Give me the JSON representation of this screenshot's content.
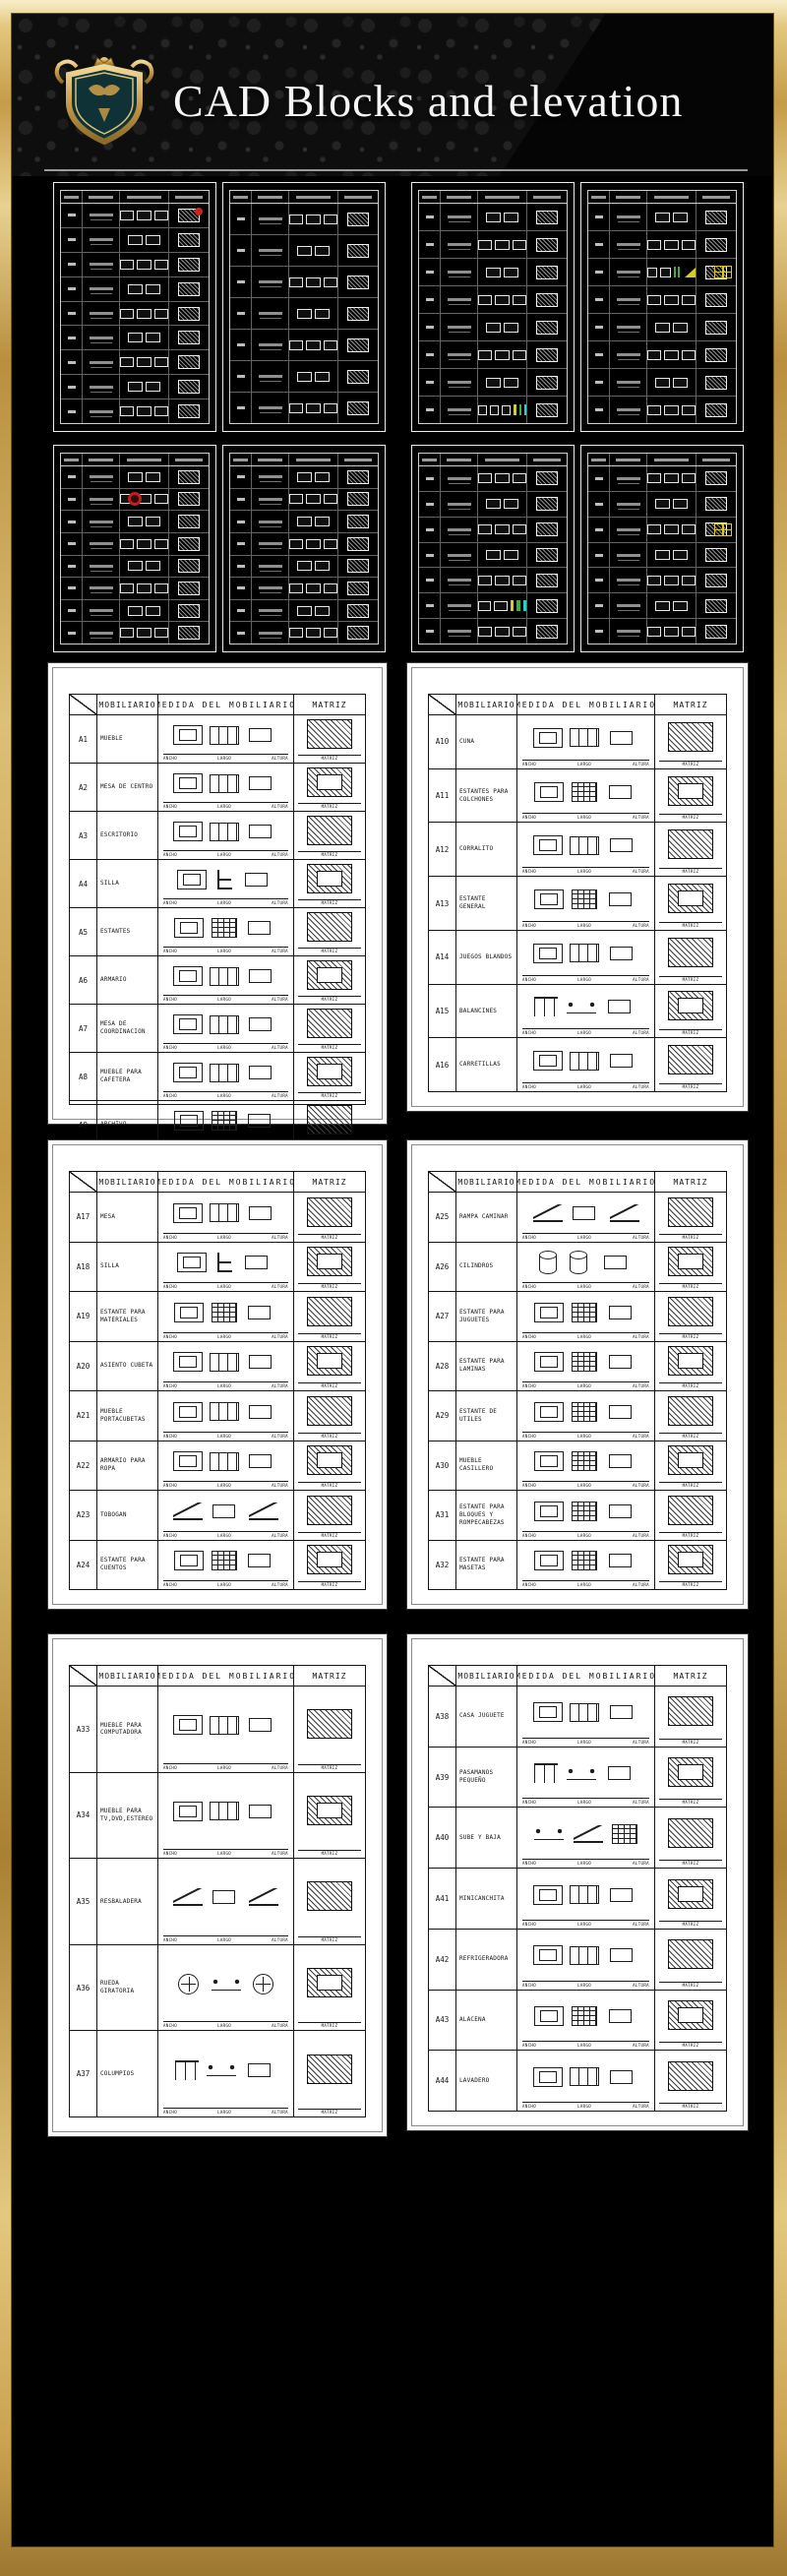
{
  "header": {
    "title": "CAD Blocks and elevation",
    "logo": "royal-crest-shield"
  },
  "colors": {
    "frame_gold": "#d9bc6d",
    "frame_gold_dark": "#a8813c",
    "background_black": "#000000",
    "sheet_white": "#ffffff",
    "line_black": "#141414",
    "dark_sheet_line": "#e6e6e6",
    "accent_red": "#cf2121",
    "accent_green": "#3fae3f",
    "accent_yellow": "#d8c832",
    "accent_cyan": "#3cc8c8",
    "title_white": "#f5f5f5"
  },
  "table_headers": {
    "furniture": "MOBILIARIO",
    "measure": "MEDIDA DEL MOBILIARIO",
    "matrix": "MATRIZ"
  },
  "dim_labels": {
    "width": "ANCHO",
    "length": "LARGO",
    "height": "ALTURA",
    "matrix": "MATRIZ"
  },
  "sheets": [
    {
      "key": "s1",
      "rows": [
        {
          "id": "A1",
          "name": "MUEBLE"
        },
        {
          "id": "A2",
          "name": "MESA DE CENTRO"
        },
        {
          "id": "A3",
          "name": "ESCRITORIO"
        },
        {
          "id": "A4",
          "name": "SILLA"
        },
        {
          "id": "A5",
          "name": "ESTANTES"
        },
        {
          "id": "A6",
          "name": "ARMARIO"
        },
        {
          "id": "A7",
          "name": "MESA DE COORDINACION"
        },
        {
          "id": "A8",
          "name": "MUEBLE PARA CAFETERA"
        },
        {
          "id": "A9",
          "name": "ARCHIVO"
        }
      ]
    },
    {
      "key": "s2",
      "rows": [
        {
          "id": "A10",
          "name": "CUNA"
        },
        {
          "id": "A11",
          "name": "ESTANTES PARA COLCHONES"
        },
        {
          "id": "A12",
          "name": "CORRALITO"
        },
        {
          "id": "A13",
          "name": "ESTANTE GENERAL"
        },
        {
          "id": "A14",
          "name": "JUEGOS BLANDOS"
        },
        {
          "id": "A15",
          "name": "BALANCINES"
        },
        {
          "id": "A16",
          "name": "CARRETILLAS"
        }
      ]
    },
    {
      "key": "s3",
      "rows": [
        {
          "id": "A17",
          "name": "MESA"
        },
        {
          "id": "A18",
          "name": "SILLA"
        },
        {
          "id": "A19",
          "name": "ESTANTE PARA MATERIALES"
        },
        {
          "id": "A20",
          "name": "ASIENTO CUBETA"
        },
        {
          "id": "A21",
          "name": "MUEBLE PORTACUBETAS"
        },
        {
          "id": "A22",
          "name": "ARMARIO PARA ROPA"
        },
        {
          "id": "A23",
          "name": "TOBOGAN"
        },
        {
          "id": "A24",
          "name": "ESTANTE PARA CUENTOS"
        }
      ]
    },
    {
      "key": "s4",
      "rows": [
        {
          "id": "A25",
          "name": "RAMPA CAMINAR"
        },
        {
          "id": "A26",
          "name": "CILINDROS"
        },
        {
          "id": "A27",
          "name": "ESTANTE PARA JUGUETES"
        },
        {
          "id": "A28",
          "name": "ESTANTE PARA LAMINAS"
        },
        {
          "id": "A29",
          "name": "ESTANTE DE UTILES"
        },
        {
          "id": "A30",
          "name": "MUEBLE CASILLERO"
        },
        {
          "id": "A31",
          "name": "ESTANTE PARA BLOQUES Y ROMPECABEZAS"
        },
        {
          "id": "A32",
          "name": "ESTANTE PARA MASETAS"
        }
      ]
    },
    {
      "key": "s5",
      "rows": [
        {
          "id": "A33",
          "name": "MUEBLE PARA COMPUTADORA"
        },
        {
          "id": "A34",
          "name": "MUEBLE PARA TV,DVD,ESTEREO"
        },
        {
          "id": "A35",
          "name": "RESBALADERA"
        },
        {
          "id": "A36",
          "name": "RUEDA GIRATORIA"
        },
        {
          "id": "A37",
          "name": "COLUMPIOS"
        }
      ]
    },
    {
      "key": "s6",
      "rows": [
        {
          "id": "A38",
          "name": "CASA JUGUETE"
        },
        {
          "id": "A39",
          "name": "PASAMANOS PEQUEÑO"
        },
        {
          "id": "A40",
          "name": "SUBE Y BAJA"
        },
        {
          "id": "A41",
          "name": "MINICANCHITA"
        },
        {
          "id": "A42",
          "name": "REFRIGERADORA"
        },
        {
          "id": "A43",
          "name": "ALACENA"
        },
        {
          "id": "A44",
          "name": "LAVADERO"
        }
      ]
    }
  ],
  "dark_sheets": [
    {
      "key": "d1",
      "rows": 9,
      "accents": [
        {
          "type": "red-dot",
          "row": 0
        }
      ]
    },
    {
      "key": "d2",
      "rows": 7,
      "accents": []
    },
    {
      "key": "d3",
      "rows": 8,
      "accents": [
        {
          "type": "color-cluster",
          "row": 7
        }
      ]
    },
    {
      "key": "d4",
      "rows": 8,
      "accents": [
        {
          "type": "green-yellow",
          "row": 2
        },
        {
          "type": "yellow-window",
          "row": 2
        }
      ]
    },
    {
      "key": "d5",
      "rows": 8,
      "accents": [
        {
          "type": "red-target",
          "row": 1
        }
      ]
    },
    {
      "key": "d6",
      "rows": 8,
      "accents": []
    },
    {
      "key": "d7",
      "rows": 7,
      "accents": [
        {
          "type": "color-cluster",
          "row": 5
        }
      ]
    },
    {
      "key": "d8",
      "rows": 7,
      "accents": [
        {
          "type": "yellow-window",
          "row": 2
        }
      ]
    }
  ]
}
